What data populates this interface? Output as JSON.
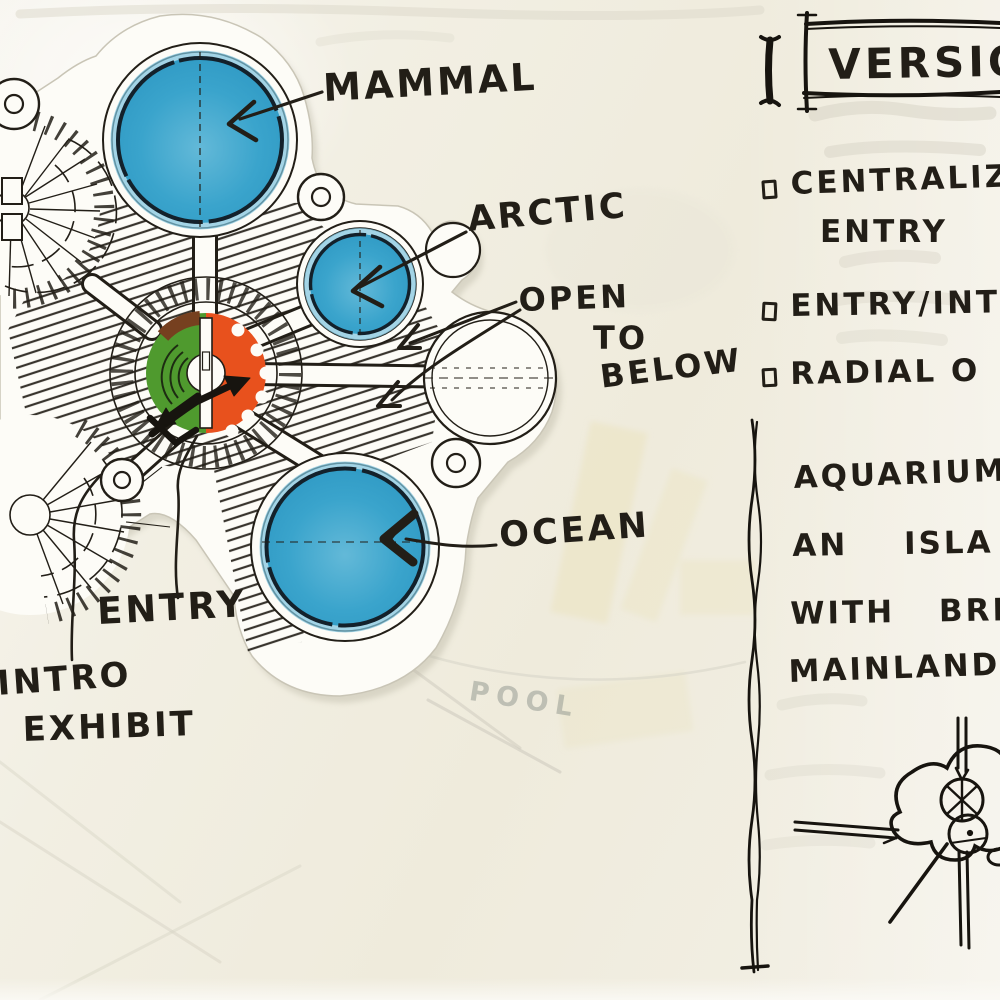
{
  "plan": {
    "labels": {
      "mammal": "MAMMAL",
      "arctic": "ARCTIC",
      "open1": "OPEN",
      "open2": "TO",
      "open3": "BELOW",
      "ocean": "OCEAN",
      "entry": "ENTRY",
      "intro1": "INTRO",
      "intro2": "EXHIBIT"
    },
    "ghost_text": "POOL",
    "colors": {
      "tank_blue": "#339fc9",
      "core_green": "#4f9a2e",
      "core_orange": "#e8511d",
      "core_brown": "#76401f",
      "ink": "#221e17",
      "paper": "#f0ecdf",
      "cutout_white": "#fdfcf7"
    }
  },
  "panel": {
    "title": "VERSION",
    "bullets": [
      {
        "line1": "CENTRALIZ",
        "line2": "ENTRY"
      },
      {
        "line1": "ENTRY/INT"
      },
      {
        "line1": "RADIAL O"
      }
    ],
    "notes": [
      "AQUARIUM",
      "AN ISLA",
      "WITH BRID",
      "MAINLAND"
    ]
  }
}
